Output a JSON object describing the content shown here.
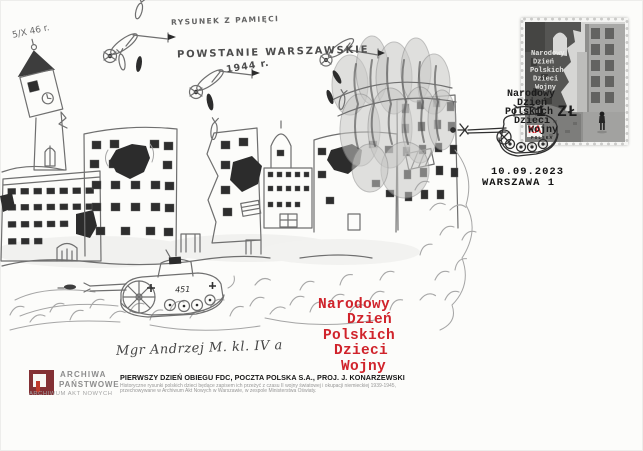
{
  "cover": {
    "corner_note": "5/X 46 r.",
    "memory_note": "RYSUNEK Z PAMIĘCI",
    "drawing_title": "POWSTANIE WARSZAWSKIE",
    "drawing_year": "1944 r.",
    "tank_marking": "451",
    "signature": "Mgr Andrzej M. kl. IV a"
  },
  "stamp": {
    "title_lines": [
      "Narodowy",
      "Dzień",
      "Polskich",
      "Dzieci",
      "Wojny"
    ]
  },
  "overprint": {
    "lines": [
      "Narodowy",
      "Dzień",
      "Polskich",
      "Dzieci"
    ],
    "value": "1 ZŁ",
    "last_word": "Wojny",
    "last_word_suffix": "KA",
    "small_caption": "POLSKA"
  },
  "postmark": {
    "date": "10.09.2023",
    "place": "WARSZAWA 1"
  },
  "red_title": {
    "lines": [
      "Narodowy",
      "Dzień",
      "Polskich",
      "Dzieci",
      "Wojny"
    ]
  },
  "publisher": {
    "name_line1": "ARCHIWA",
    "name_line2": "PAŃSTWOWE",
    "subtitle": "ARCHIWUM AKT NOWYCH"
  },
  "imprint": {
    "fdc_line": "PIERWSZY DZIEŃ OBIEGU FDC, POCZTA POLSKA S.A., PROJ. J. KONARZEWSKI",
    "description_line1": "Historyczne rysunki polskich dzieci będące zapisem ich przeżyć z czasu II wojny światowej i okupacji niemieckiej 1939-1945,",
    "description_line2": "przechowywane w Archiwum Akt Nowych w Warszawie, w zespole Ministerstwa Oświaty."
  },
  "colors": {
    "accent_red": "#d0232b",
    "logo_maroon": "#833034",
    "pencil": "#6f6f6f"
  }
}
